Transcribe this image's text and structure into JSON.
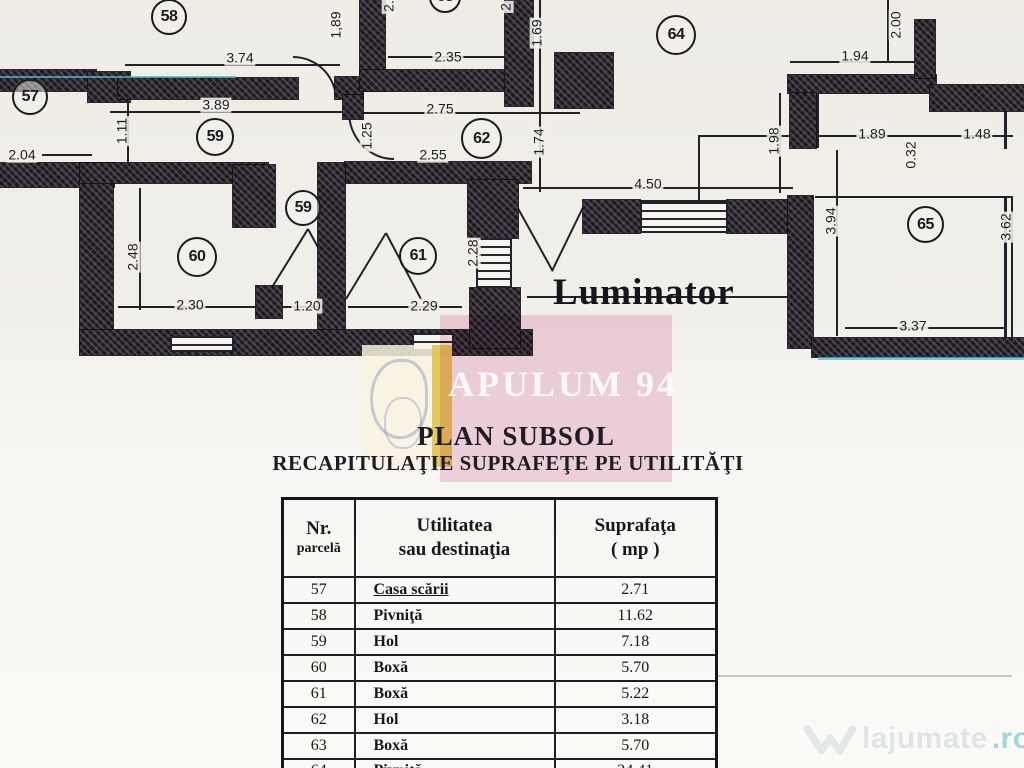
{
  "plan": {
    "luminator": "Luminator",
    "rooms": [
      {
        "id": "57",
        "x": 12,
        "y": 79,
        "d": 36
      },
      {
        "id": "58",
        "x": 151,
        "y": -1,
        "d": 36
      },
      {
        "id": "63",
        "x": 429,
        "y": -19,
        "d": 32
      },
      {
        "id": "64",
        "x": 656,
        "y": 15,
        "d": 40
      },
      {
        "id": "59",
        "x": 196,
        "y": 118,
        "d": 38
      },
      {
        "id": "62",
        "x": 461,
        "y": 118,
        "d": 41
      },
      {
        "id": "59",
        "x": 285,
        "y": 190,
        "d": 36
      },
      {
        "id": "60",
        "x": 177,
        "y": 237,
        "d": 40
      },
      {
        "id": "61",
        "x": 399,
        "y": 237,
        "d": 38
      },
      {
        "id": "65",
        "x": 907,
        "y": 206,
        "d": 37
      }
    ],
    "dims": [
      {
        "t": "3.74",
        "x": 240,
        "y": 58
      },
      {
        "t": "3.89",
        "x": 216,
        "y": 105
      },
      {
        "t": "2.04",
        "x": 22,
        "y": 155
      },
      {
        "t": "1.11",
        "x": 122,
        "y": 131,
        "v": 1
      },
      {
        "t": "1,89",
        "x": 336,
        "y": 25,
        "v": 1
      },
      {
        "t": "2.",
        "x": 389,
        "y": 6,
        "v": 1
      },
      {
        "t": "2",
        "x": 506,
        "y": 7,
        "v": 1
      },
      {
        "t": "2.35",
        "x": 448,
        "y": 57
      },
      {
        "t": "1.69",
        "x": 537,
        "y": 33,
        "v": 1
      },
      {
        "t": "2.75",
        "x": 440,
        "y": 109
      },
      {
        "t": "1.25",
        "x": 367,
        "y": 136,
        "v": 1
      },
      {
        "t": "2.55",
        "x": 433,
        "y": 155
      },
      {
        "t": "1.74",
        "x": 539,
        "y": 142,
        "v": 1
      },
      {
        "t": "2.48",
        "x": 133,
        "y": 257,
        "v": 1
      },
      {
        "t": "2.30",
        "x": 190,
        "y": 305
      },
      {
        "t": "1.20",
        "x": 307,
        "y": 306
      },
      {
        "t": "2.29",
        "x": 424,
        "y": 306
      },
      {
        "t": "2.28",
        "x": 473,
        "y": 253,
        "v": 1
      },
      {
        "t": "4.50",
        "x": 648,
        "y": 184
      },
      {
        "t": "1.94",
        "x": 855,
        "y": 56
      },
      {
        "t": "2.00",
        "x": 896,
        "y": 25,
        "v": 1
      },
      {
        "t": "1.98",
        "x": 774,
        "y": 141,
        "v": 1
      },
      {
        "t": "1.89",
        "x": 872,
        "y": 134
      },
      {
        "t": "0.32",
        "x": 911,
        "y": 155,
        "v": 1
      },
      {
        "t": "1.48",
        "x": 977,
        "y": 134
      },
      {
        "t": "3.94",
        "x": 831,
        "y": 221,
        "v": 1
      },
      {
        "t": "3.62",
        "x": 1006,
        "y": 227,
        "v": 1
      },
      {
        "t": "3.37",
        "x": 913,
        "y": 326
      }
    ],
    "walls": [
      [
        0,
        70,
        96,
        21
      ],
      [
        88,
        72,
        42,
        30
      ],
      [
        118,
        78,
        180,
        21
      ],
      [
        335,
        77,
        28,
        22
      ],
      [
        360,
        0,
        25,
        91
      ],
      [
        360,
        70,
        172,
        21
      ],
      [
        505,
        0,
        28,
        106
      ],
      [
        555,
        53,
        58,
        55
      ],
      [
        343,
        95,
        20,
        24
      ],
      [
        345,
        162,
        186,
        21
      ],
      [
        0,
        163,
        114,
        24
      ],
      [
        80,
        163,
        33,
        186
      ],
      [
        80,
        163,
        188,
        20
      ],
      [
        233,
        165,
        42,
        62
      ],
      [
        256,
        286,
        26,
        32
      ],
      [
        318,
        163,
        27,
        186
      ],
      [
        80,
        330,
        452,
        25
      ],
      [
        468,
        180,
        50,
        58
      ],
      [
        470,
        288,
        50,
        60
      ],
      [
        583,
        200,
        57,
        33
      ],
      [
        727,
        200,
        81,
        33
      ],
      [
        788,
        75,
        148,
        18
      ],
      [
        915,
        20,
        20,
        58
      ],
      [
        930,
        85,
        94,
        26
      ],
      [
        790,
        93,
        26,
        55
      ],
      [
        788,
        196,
        25,
        152
      ],
      [
        812,
        338,
        212,
        19
      ]
    ],
    "windows": [
      [
        170,
        336,
        64,
        16
      ],
      [
        412,
        333,
        42,
        18
      ],
      [
        640,
        202,
        88,
        31
      ],
      [
        476,
        238,
        36,
        50
      ]
    ],
    "lines": [
      [
        125,
        64,
        215,
        2
      ],
      [
        110,
        111,
        235,
        2
      ],
      [
        42,
        154,
        50,
        2
      ],
      [
        388,
        56,
        118,
        2
      ],
      [
        348,
        112,
        232,
        2
      ],
      [
        523,
        187,
        270,
        2
      ],
      [
        118,
        306,
        160,
        2
      ],
      [
        282,
        306,
        62,
        2
      ],
      [
        348,
        306,
        114,
        2
      ],
      [
        790,
        61,
        128,
        2
      ],
      [
        698,
        135,
        315,
        2
      ],
      [
        815,
        196,
        198,
        2
      ],
      [
        527,
        296,
        268,
        2
      ],
      [
        845,
        327,
        162,
        2
      ],
      [
        127,
        100,
        2,
        62
      ],
      [
        139,
        188,
        2,
        122
      ],
      [
        479,
        192,
        2,
        116
      ],
      [
        539,
        0,
        2,
        192
      ],
      [
        836,
        150,
        2,
        186
      ],
      [
        779,
        93,
        2,
        100
      ],
      [
        887,
        0,
        2,
        62
      ],
      [
        698,
        135,
        2,
        66
      ],
      [
        816,
        93,
        3,
        55
      ],
      [
        1004,
        196,
        3,
        152
      ],
      [
        1011,
        196,
        2,
        152
      ],
      [
        1004,
        111,
        3,
        38
      ],
      [
        583,
        200,
        225,
        2
      ],
      [
        583,
        231,
        225,
        2
      ]
    ],
    "cyan_lines": [
      [
        0,
        76,
        236,
        2
      ],
      [
        818,
        357,
        206,
        3
      ]
    ],
    "faint_lines": [
      [
        716,
        675,
        296,
        2
      ]
    ],
    "strokes": [
      [
        515,
        202,
        78,
        61
      ],
      [
        552,
        270,
        71,
        -64
      ],
      [
        266,
        296,
        80,
        -58.3
      ],
      [
        308,
        228,
        75,
        61.4
      ],
      [
        346,
        298,
        77,
        -58.8
      ],
      [
        386,
        232,
        77,
        62.1
      ]
    ],
    "arcs": [
      {
        "x": 293,
        "y": 56,
        "w": 42,
        "h": 42,
        "c": "tr"
      },
      {
        "x": 348,
        "y": 112,
        "w": 44,
        "h": 46,
        "c": "bl"
      }
    ]
  },
  "watermark": {
    "apulum": "APULUM 94",
    "site_name": "lajumate",
    "site_tld": ".ro"
  },
  "titles": {
    "main": "PLAN SUBSOL",
    "subtitle": "RECAPITULAŢIE SUPRAFEŢE PE UTILITĂŢI"
  },
  "table": {
    "col1_l1": "Nr.",
    "col1_l2": "parcelă",
    "col2_l1": "Utilitatea",
    "col2_l2": "sau destinaţia",
    "col3_l1": "Suprafaţa",
    "col3_l2": "( mp )",
    "rows": [
      [
        "57",
        "Casa scării",
        "2.71"
      ],
      [
        "58",
        "Pivniţă",
        "11.62"
      ],
      [
        "59",
        "Hol",
        "7.18"
      ],
      [
        "60",
        "Boxă",
        "5.70"
      ],
      [
        "61",
        "Boxă",
        "5.22"
      ],
      [
        "62",
        "Hol",
        "3.18"
      ],
      [
        "63",
        "Boxă",
        "5.70"
      ],
      [
        "64",
        "Pivniţă",
        "24.41"
      ]
    ]
  }
}
